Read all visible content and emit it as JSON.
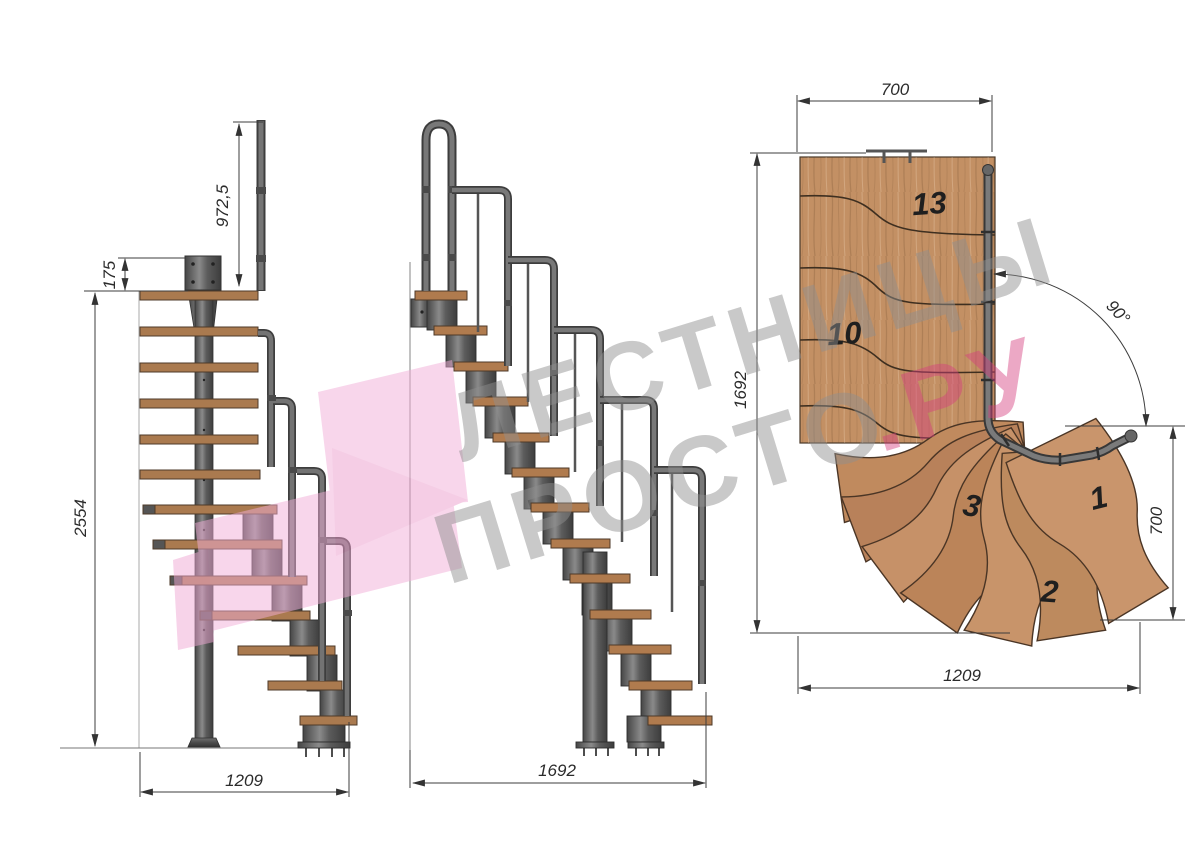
{
  "drawing_title": "Modular 90-degree turn staircase technical drawing",
  "side_view": {
    "dim_handrail_height": "972,5",
    "dim_plate_height": "175",
    "dim_total_height": "2554",
    "dim_footprint_width": "1209"
  },
  "front_view": {
    "dim_footprint_width": "1692"
  },
  "plan_view": {
    "dim_top_width": "700",
    "dim_left_depth": "1692",
    "dim_turn_angle": "90°",
    "dim_right_depth": "700",
    "dim_bottom_width": "1209",
    "steps": {
      "s13": "13",
      "s10": "10",
      "s3": "3",
      "s1": "1",
      "s2": "2"
    }
  },
  "watermark": {
    "line1": "ЛЕСТНИЦЫ",
    "line2": "ПРОСТО",
    "line2_suffix": ".РУ"
  },
  "colors": {
    "background": "#ffffff",
    "wood_plan": "#c39064",
    "wood_side": "#aa7a4f",
    "steel": "#5a5a5a",
    "dim_line": "#3c3c3c",
    "watermark_grey": "#999999",
    "watermark_pink": "#d5407f",
    "logo_pink": "#f2aed8"
  }
}
